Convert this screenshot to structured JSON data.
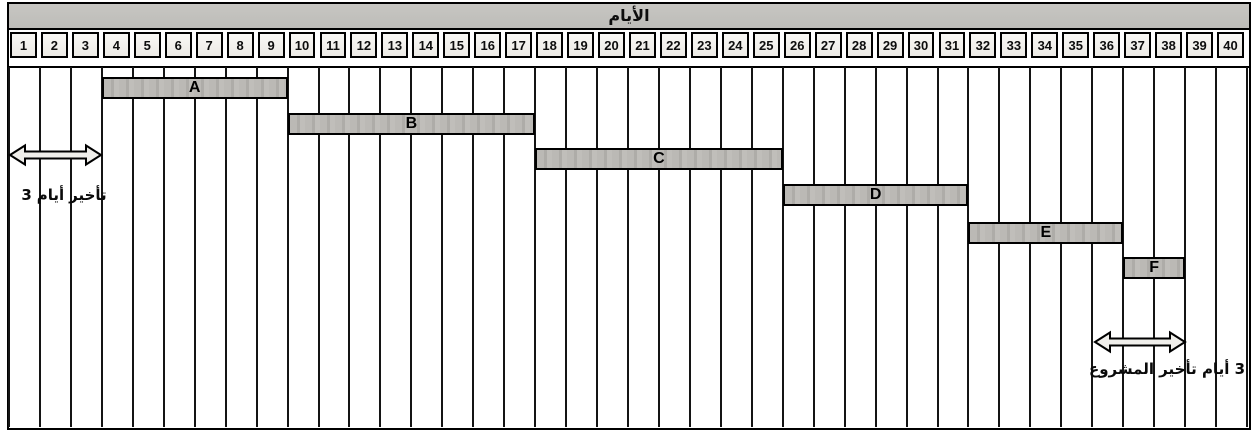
{
  "chart_data": {
    "type": "bar",
    "subtype": "gantt",
    "title": "الأيام",
    "x_axis_label": "الأيام",
    "x_range": [
      1,
      40
    ],
    "grid": true,
    "day_ticks": [
      1,
      2,
      3,
      4,
      5,
      6,
      7,
      8,
      9,
      10,
      11,
      12,
      13,
      14,
      15,
      16,
      17,
      18,
      19,
      20,
      21,
      22,
      23,
      24,
      25,
      26,
      27,
      28,
      29,
      30,
      31,
      32,
      33,
      34,
      35,
      36,
      37,
      38,
      39,
      40
    ],
    "tasks": [
      {
        "name": "A",
        "start_day": 4,
        "end_day": 9,
        "duration_days": 6
      },
      {
        "name": "B",
        "start_day": 10,
        "end_day": 17,
        "duration_days": 8
      },
      {
        "name": "C",
        "start_day": 18,
        "end_day": 25,
        "duration_days": 8
      },
      {
        "name": "D",
        "start_day": 26,
        "end_day": 31,
        "duration_days": 6
      },
      {
        "name": "E",
        "start_day": 32,
        "end_day": 36,
        "duration_days": 5
      },
      {
        "name": "F",
        "start_day": 37,
        "end_day": 38,
        "duration_days": 2
      }
    ],
    "annotations": [
      {
        "id": "start-delay",
        "text": "3 أيام تأخير",
        "parts": [
          "3",
          "أيام",
          "تأخير"
        ],
        "from_day": 1,
        "to_day": 3,
        "marker": "double-headed-arrow"
      },
      {
        "id": "project-end-delay",
        "text": "3 أيام تأخير المشروع",
        "from_day": 36,
        "to_day": 38,
        "marker": "double-headed-arrow"
      }
    ]
  },
  "colors": {
    "header_bg": "#c7c6c2",
    "cell_bg": "#eceae5",
    "bar_fill": "#b5b3af",
    "line": "#141414",
    "arrow_fill": "#f0efeb",
    "background": "#ffffff"
  }
}
